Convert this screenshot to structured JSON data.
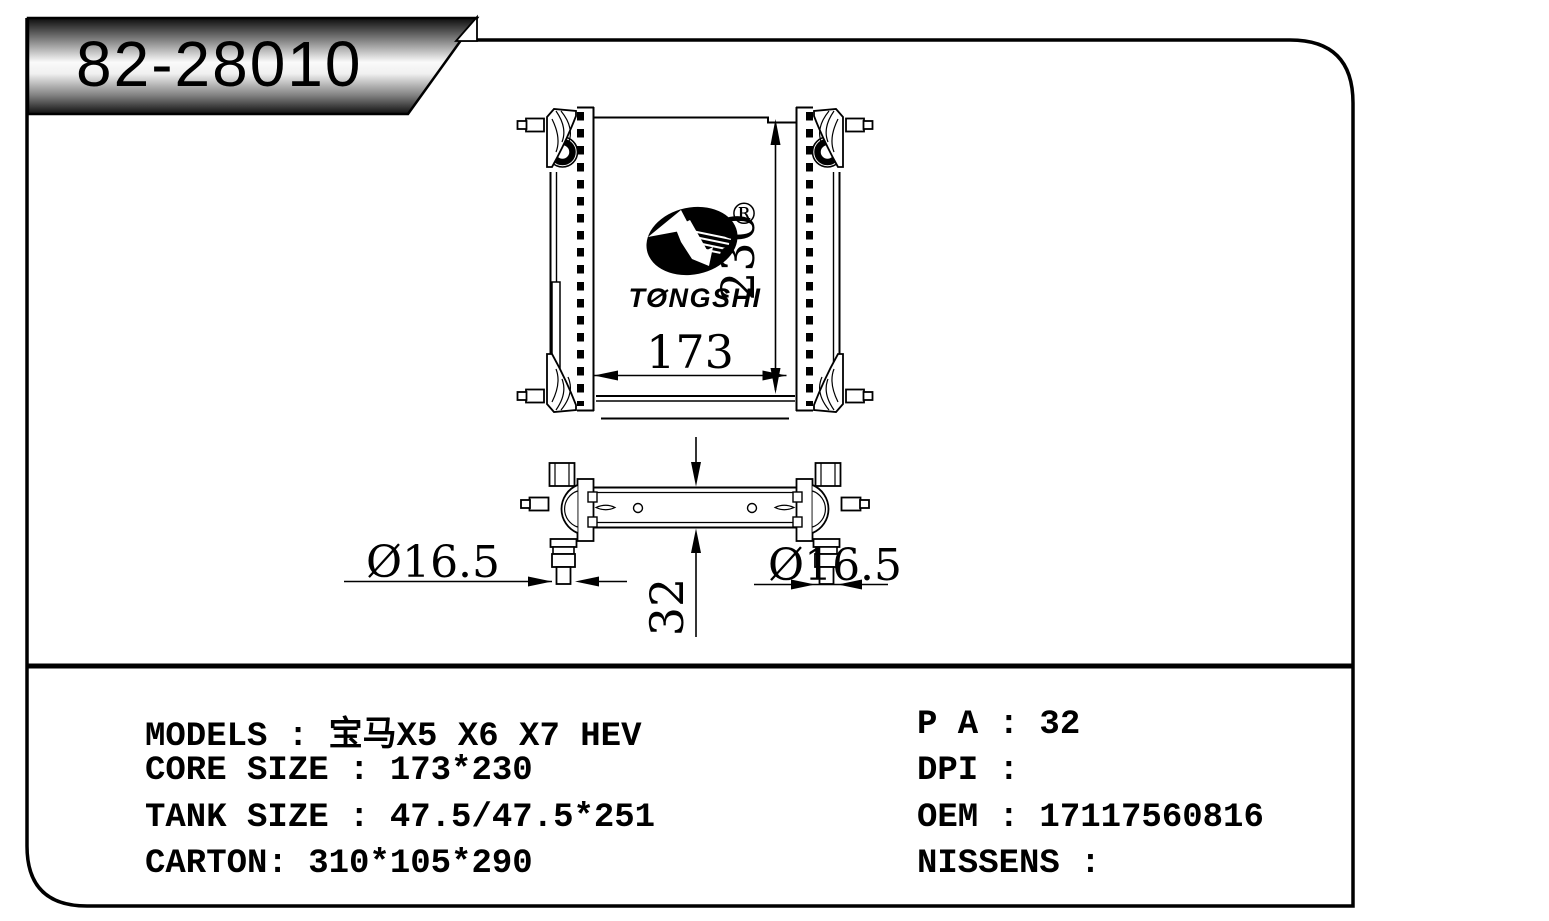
{
  "part_header": {
    "part_number": "82-28010"
  },
  "logo": {
    "brand": "TONGSHI",
    "registered_mark": "®"
  },
  "drawing": {
    "front_view": {
      "width_dim": "173",
      "height_dim": "230"
    },
    "top_view": {
      "thickness_dim": "32",
      "left_pipe_dim": "Ø16.5",
      "right_pipe_dim": "Ø16.5"
    }
  },
  "specs": {
    "left_column": [
      "MODELS : 宝马X5 X6 X7 HEV",
      "CORE SIZE : 173*230",
      "TANK SIZE : 47.5/47.5*251",
      "CARTON: 310*105*290"
    ],
    "right_column": [
      "P A : 32",
      "DPI :",
      "OEM : 17117560816",
      "NISSENS :"
    ]
  },
  "colors": {
    "line": "#000000",
    "background": "#ffffff",
    "banner_dark": "#0c0c0c",
    "banner_light": "#fafafa"
  }
}
